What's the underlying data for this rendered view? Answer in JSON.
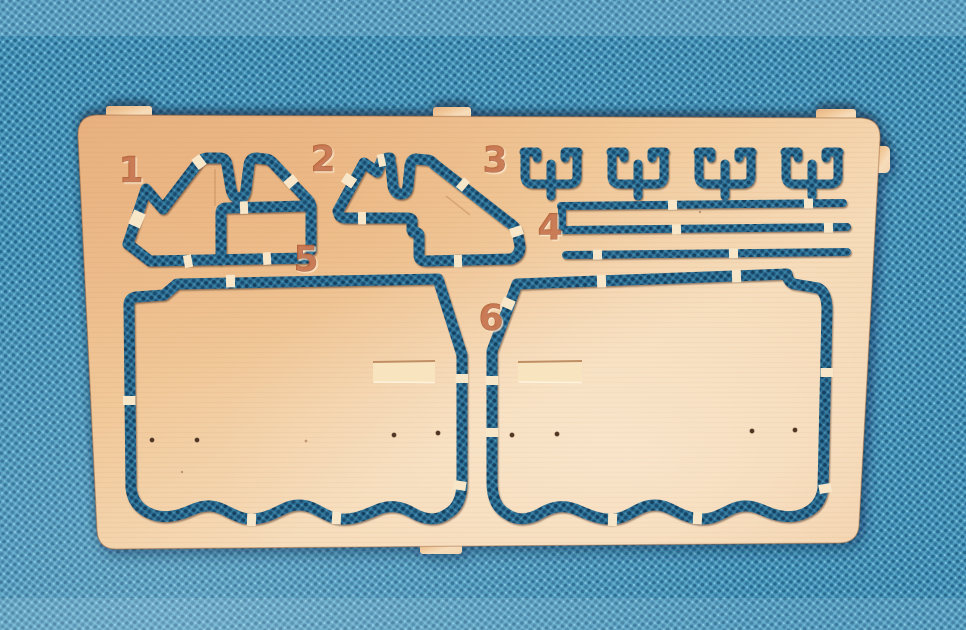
{
  "scene": {
    "type": "photograph",
    "subject": "Photo-etched copper fret with six numbered model parts lying on blue woven fabric",
    "colors": {
      "fabric": "#4a98bc",
      "fabric_dot_dark": "#27688f",
      "fabric_in_cutout": "#2d7094",
      "copper": "#f0c89d",
      "copper_pale": "#f6dcba",
      "etched_number": "#c2683c",
      "attachment_tab": "#f7e6c8"
    }
  },
  "fret": {
    "labels": [
      {
        "text": "1"
      },
      {
        "text": "2"
      },
      {
        "text": "3"
      },
      {
        "text": "4"
      },
      {
        "text": "5"
      },
      {
        "text": "6"
      }
    ]
  }
}
